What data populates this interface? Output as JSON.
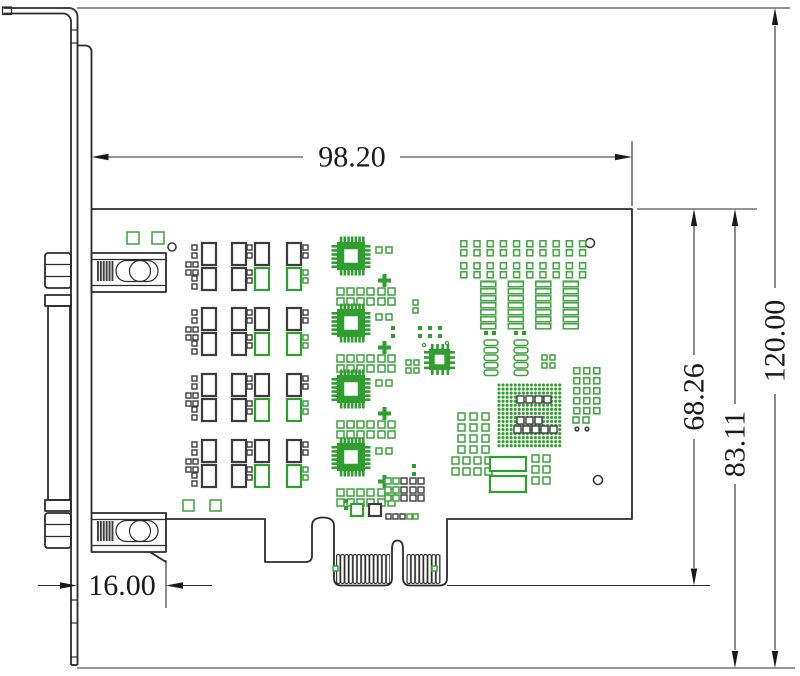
{
  "drawing": {
    "type": "mechanical-dimension-drawing",
    "subject": "PCIe expansion card side profile with bracket and edge connector",
    "dimensions": {
      "pcb_length": "98.20",
      "overall_height": "120.00",
      "board_height_with_fingers": "83.11",
      "board_height": "68.26",
      "bracket_offset": "16.00"
    },
    "colors": {
      "line": "#2b2b2b",
      "component_green": "#2f9e2f",
      "component_dark": "#3b3b3b",
      "background": "#ffffff"
    }
  }
}
